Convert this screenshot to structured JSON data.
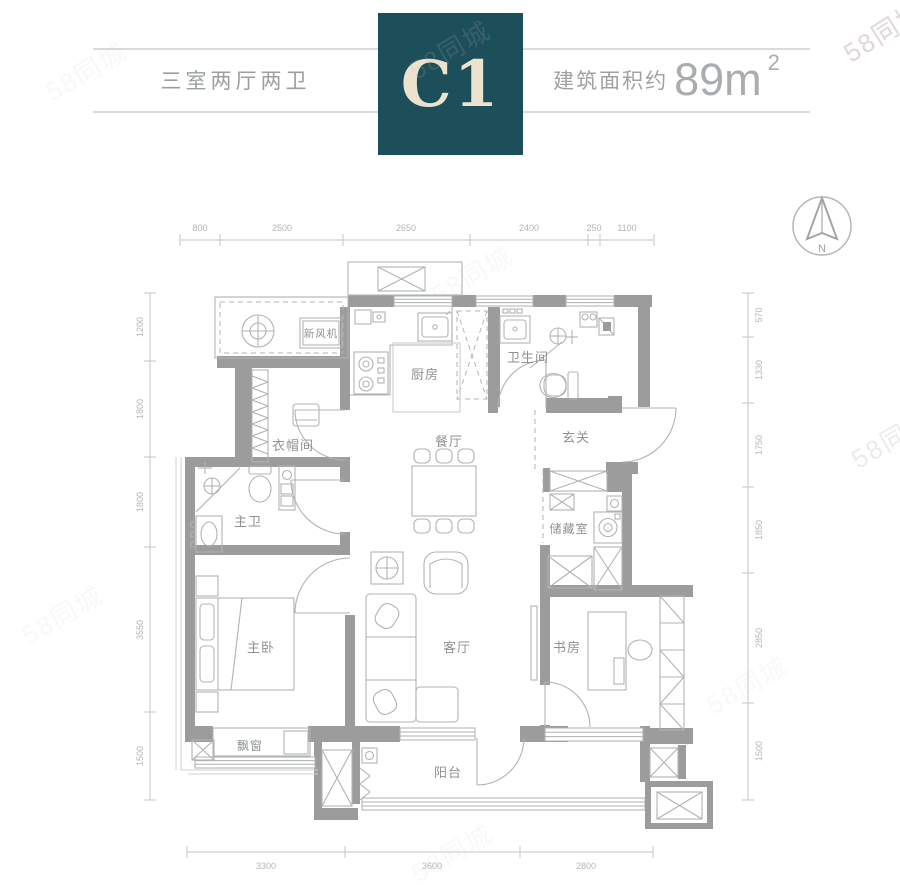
{
  "header": {
    "layout_label": "三室两厅两卫",
    "unit_code": "C1",
    "area_prefix": "建筑面积约",
    "area_value": "89m",
    "area_sup": "2"
  },
  "compass": {
    "north_label": "N"
  },
  "watermark": {
    "text": "58同城"
  },
  "room_labels": {
    "fresh_air": "新风机",
    "kitchen": "厨房",
    "bathroom": "卫生间",
    "cloakroom": "衣帽间",
    "dining": "餐厅",
    "foyer": "玄关",
    "master_bath": "主卫",
    "storage": "储藏室",
    "master_bedroom": "主卧",
    "living": "客厅",
    "study": "书房",
    "bay_window": "飘窗",
    "balcony": "阳台"
  },
  "dimensions": {
    "top": [
      "800",
      "2500",
      "2650",
      "2400",
      "250",
      "1100"
    ],
    "left": [
      "1200",
      "1800",
      "1800",
      "3550",
      "1500"
    ],
    "right": [
      "570",
      "1330",
      "1750",
      "1850",
      "2850",
      "1500"
    ],
    "bottom": [
      "3300",
      "3600",
      "2800"
    ]
  },
  "colors": {
    "accent": "#1d4f5a",
    "unit_text": "#ebe3cd",
    "wall": "#9c9c9c",
    "furniture_line": "#b0b3b5",
    "dim_text": "#b2b5b7"
  }
}
